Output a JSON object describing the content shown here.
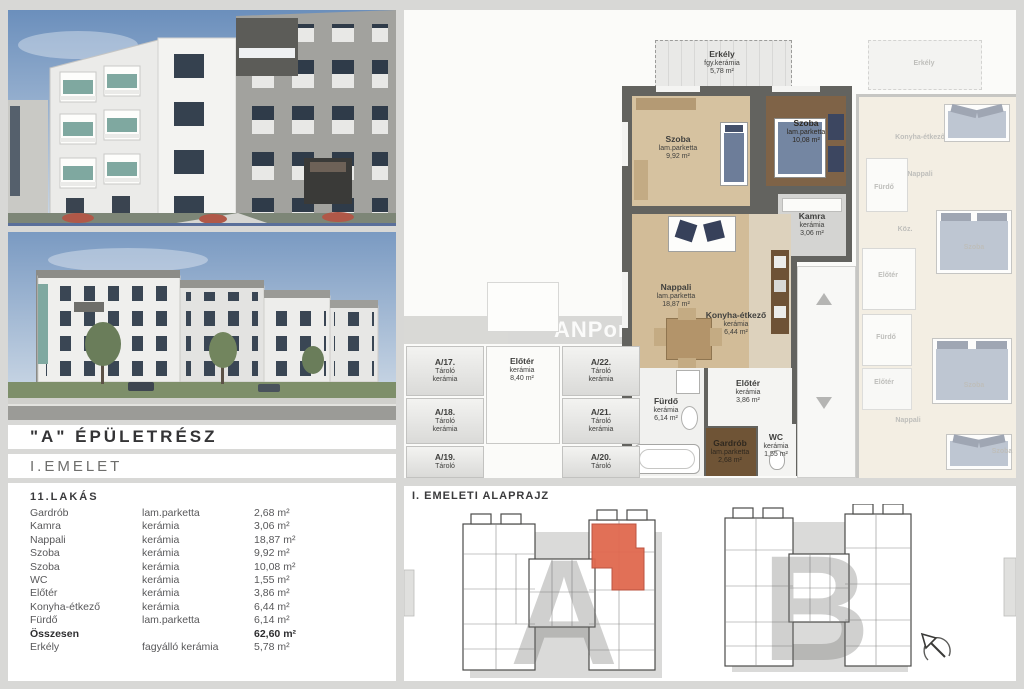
{
  "header": {
    "building_section": "\"A\" ÉPÜLETRÉSZ",
    "floor": "I.EMELET",
    "apartment": "11.LAKÁS"
  },
  "unit_table": {
    "rows": [
      {
        "name": "Gardrób",
        "material": "lam.parketta",
        "area": "2,68 m²"
      },
      {
        "name": "Kamra",
        "material": "kerámia",
        "area": "3,06 m²"
      },
      {
        "name": "Nappali",
        "material": "kerámia",
        "area": "18,87 m²"
      },
      {
        "name": "Szoba",
        "material": "kerámia",
        "area": "9,92 m²"
      },
      {
        "name": "Szoba",
        "material": "kerámia",
        "area": "10,08 m²"
      },
      {
        "name": "WC",
        "material": "kerámia",
        "area": "1,55 m²"
      },
      {
        "name": "Előtér",
        "material": "kerámia",
        "area": "3,86 m²"
      },
      {
        "name": "Konyha-étkező",
        "material": "kerámia",
        "area": "6,44 m²"
      },
      {
        "name": "Fürdő",
        "material": "lam.parketta",
        "area": "6,14 m²"
      },
      {
        "name": "Összesen",
        "material": "",
        "area": "62,60 m²"
      },
      {
        "name": "Erkély",
        "material": "fagyálló kerámia",
        "area": "5,78 m²"
      }
    ]
  },
  "floor_plan": {
    "watermark": "ANPont",
    "rooms": {
      "erkely": {
        "name": "Erkély",
        "material": "fgy.kerámia",
        "area": "5,78 m²"
      },
      "szoba1": {
        "name": "Szoba",
        "material": "lam.parketta",
        "area": "9,92 m²"
      },
      "szoba2": {
        "name": "Szoba",
        "material": "lam.parketta",
        "area": "10,08 m²"
      },
      "kamra": {
        "name": "Kamra",
        "material": "kerámia",
        "area": "3,06 m²"
      },
      "nappali": {
        "name": "Nappali",
        "material": "lam.parketta",
        "area": "18,87 m²"
      },
      "konyha": {
        "name": "Konyha-étkező",
        "material": "kerámia",
        "area": "6,44 m²"
      },
      "eloter": {
        "name": "Előtér",
        "material": "kerámia",
        "area": "3,86 m²"
      },
      "furdo": {
        "name": "Fürdő",
        "material": "kerámia",
        "area": "6,14 m²"
      },
      "gardrob": {
        "name": "Gardrób",
        "material": "lam.parketta",
        "area": "2,68 m²"
      },
      "wc": {
        "name": "WC",
        "material": "kerámia",
        "area": "1,55 m²"
      },
      "kozos_eloter": {
        "name": "Előtér",
        "material": "kerámia",
        "area": "8,40 m²"
      }
    },
    "storage": [
      {
        "id": "A/17.",
        "name": "Tároló",
        "material": "kerámia"
      },
      {
        "id": "A/18.",
        "name": "Tároló",
        "material": "kerámia"
      },
      {
        "id": "A/19.",
        "name": "Tároló",
        "material": "kerámia"
      },
      {
        "id": "A/22.",
        "name": "Tároló",
        "material": "kerámia"
      },
      {
        "id": "A/21.",
        "name": "Tároló",
        "material": "kerámia"
      },
      {
        "id": "A/20.",
        "name": "Tároló",
        "material": "kerámia"
      }
    ],
    "neighbor_labels": [
      "Erkély",
      "Konyha-étkező",
      "Nappali",
      "Fürdő",
      "Köz.",
      "Szoba",
      "Előtér",
      "Fürdő",
      "Előtér",
      "Szoba",
      "Nappali",
      "Szoba"
    ]
  },
  "overview": {
    "title": "I. EMELETI ALAPRAJZ",
    "building_a": "A",
    "building_b": "B"
  },
  "colors": {
    "accent_red": "#e0694f",
    "wood_light": "#d5c09c",
    "wood_dark": "#7e6247",
    "wall_gray": "#63635f"
  }
}
